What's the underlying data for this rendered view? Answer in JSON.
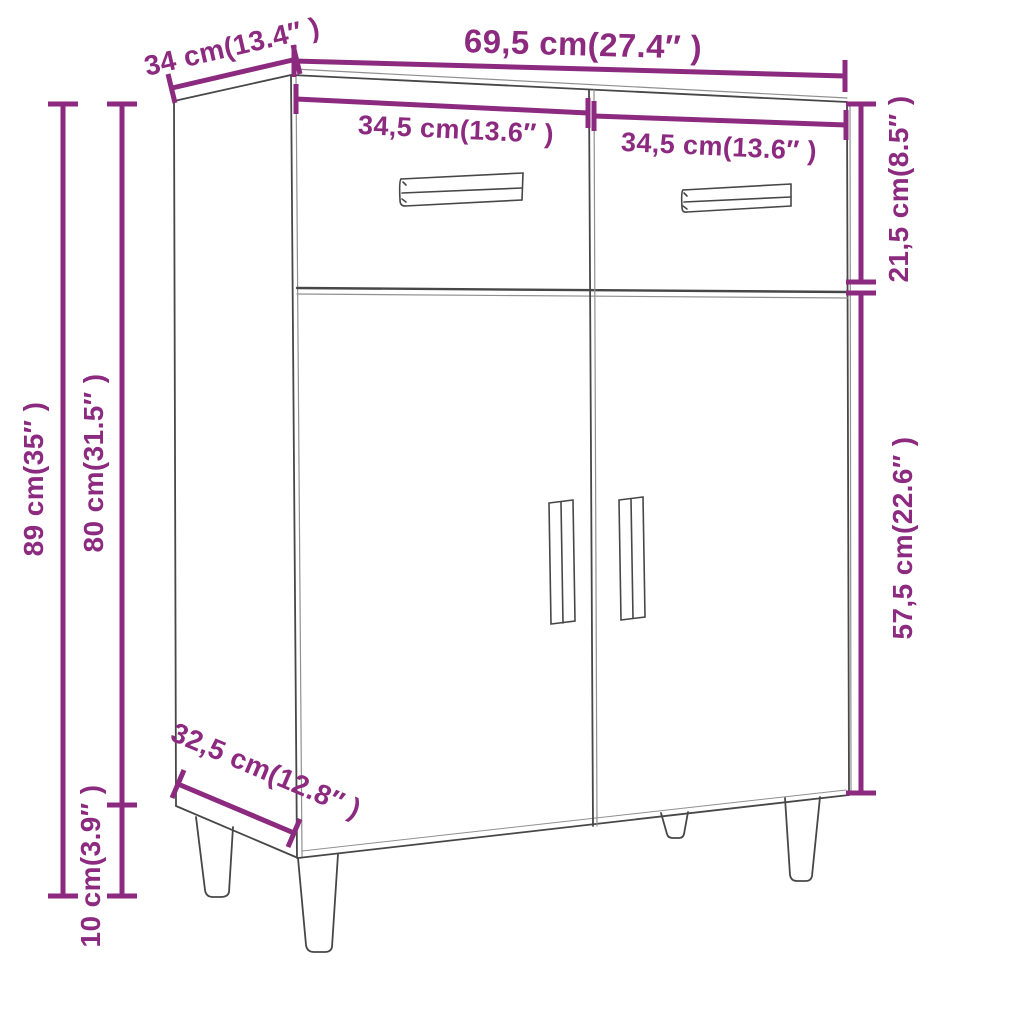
{
  "title": "Sideboard dimension diagram",
  "accent_color": "#8c2a80",
  "line_color": "#474747",
  "background_color": "#ffffff",
  "product": "sideboard with 2 drawers, 2 doors and 4 tapered legs",
  "dimensions": {
    "total_width": "69,5 cm(27.4″ )",
    "top_depth": "34 cm(13.4″ )",
    "left_drawer_width": "34,5 cm(13.6″ )",
    "right_drawer_width": "34,5 cm(13.6″ )",
    "drawer_section_height": "21,5 cm(8.5″ )",
    "door_section_height": "57,5 cm(22.6″ )",
    "total_height": "89 cm(35″ )",
    "body_height": "80 cm(31.5″ )",
    "leg_height": "10 cm(3.9″ )",
    "bottom_depth": "32,5 cm(12.8″ )"
  }
}
